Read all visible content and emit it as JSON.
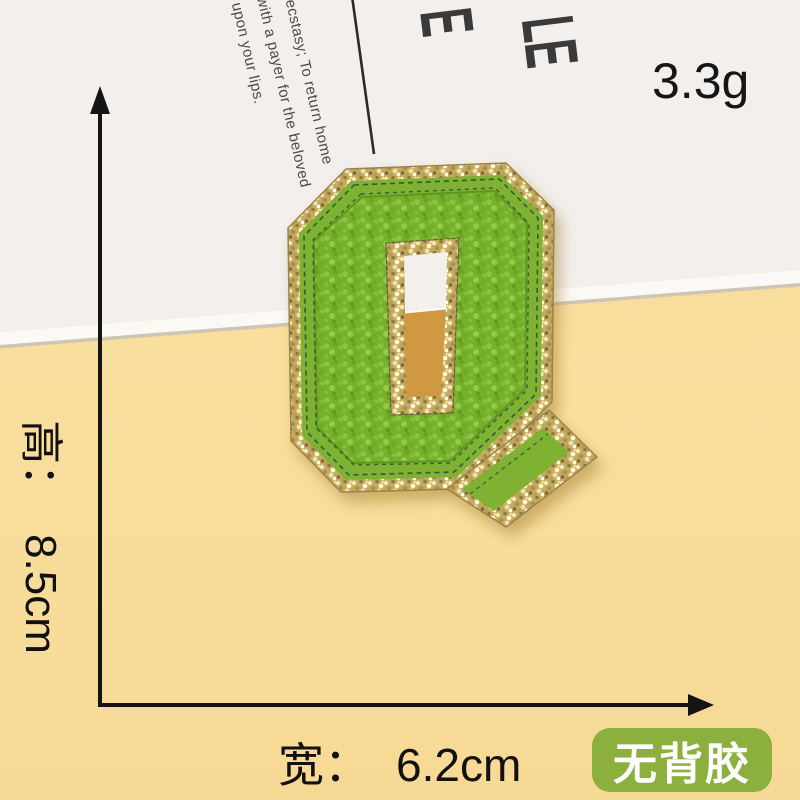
{
  "patch": {
    "letter": "Q",
    "description": "green chenille varsity letter patch with gold glitter border",
    "colors": {
      "chenille_green": "#77b02b",
      "felt_green": "#7fb133",
      "glitter_gold": "#c3a95c",
      "stitch_dark": "#24453a"
    }
  },
  "annotations": {
    "weight": "3.3g",
    "height": {
      "label": "高：",
      "value": "8.5cm"
    },
    "width": {
      "label": "宽：",
      "value": "6.2cm"
    },
    "badge": "无背胶",
    "line_color": "#141414",
    "badge_color": "#8cb03e"
  },
  "card": {
    "poem_lines": [
      ", ecstasy; To return home",
      "with a payer for the beloved",
      "upon your lips."
    ],
    "big_letters": [
      "E",
      "LE"
    ]
  },
  "background": {
    "table_yellow": "#f8dc9b",
    "paper_white": "#f2efec",
    "hole_shadow_amber": "#d0983f"
  }
}
